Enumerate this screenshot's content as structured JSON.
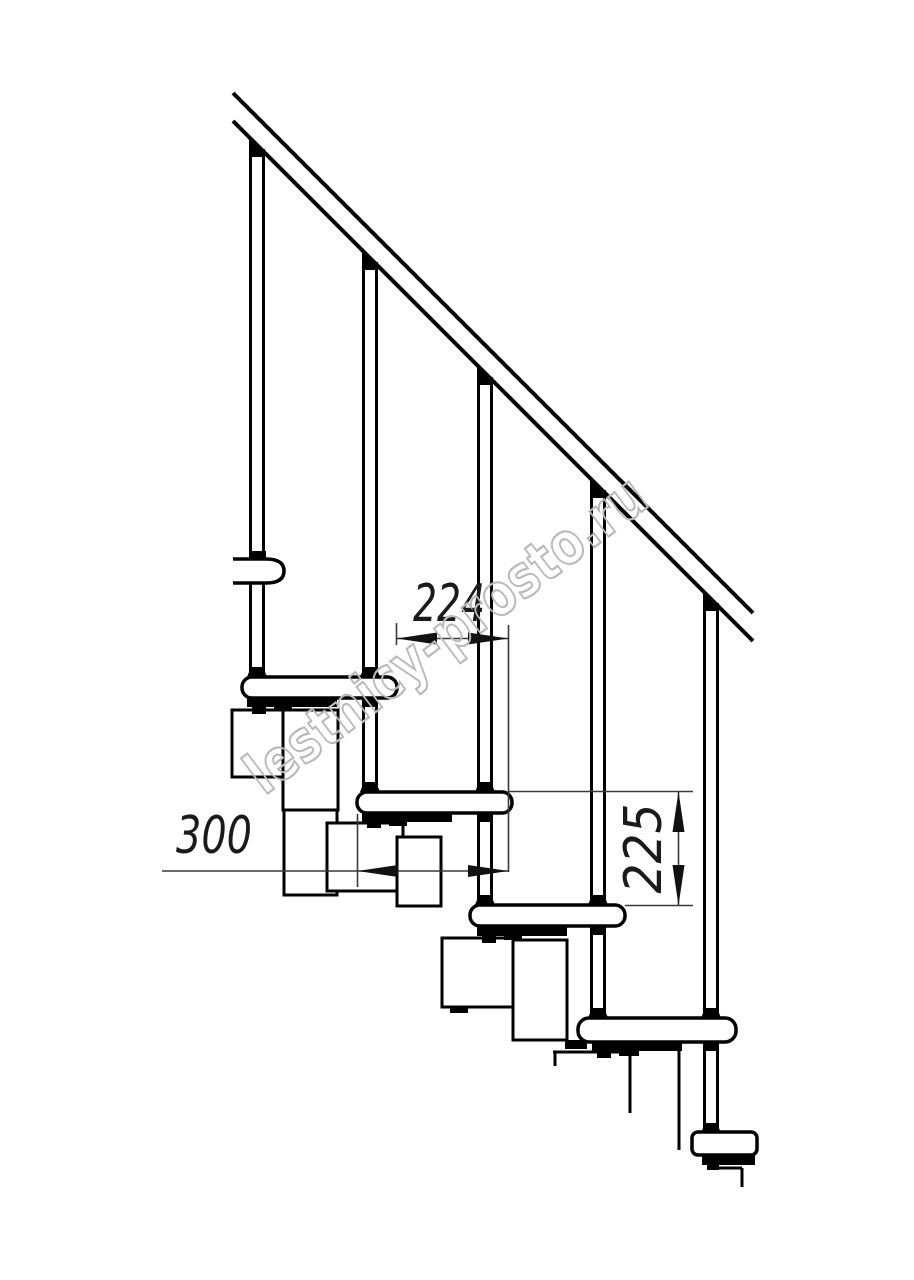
{
  "page": {
    "background": "#ffffff"
  },
  "drawing": {
    "type": "technical-line-drawing",
    "subject": "modular staircase side elevation with handrail, balusters, treads and support modules",
    "watermark": "lestnicy-prosto.ru",
    "dimensions": {
      "going": "224",
      "tread_depth": "300",
      "rise": "225"
    },
    "counts": {
      "treads_visible": 5,
      "balusters_visible": 5
    },
    "colors": {
      "line": "#000000",
      "fill": "#ffffff",
      "dimension_line": "#3a3a3a",
      "dimension_text": "#1a1a1a",
      "watermark": "#b9b9b9"
    }
  }
}
